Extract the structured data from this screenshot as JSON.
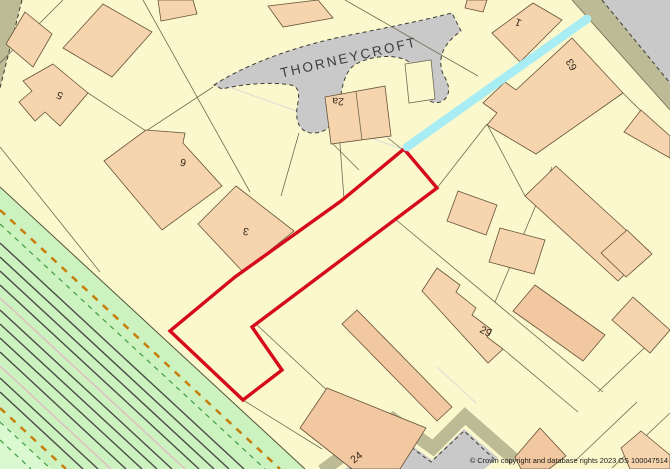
{
  "map": {
    "street_label": "THORNEYCROFT",
    "house_labels": [
      {
        "text": "5"
      },
      {
        "text": "6"
      },
      {
        "text": "3"
      },
      {
        "text": "2a"
      },
      {
        "text": "1"
      },
      {
        "text": "63"
      },
      {
        "text": "29"
      },
      {
        "text": "24"
      }
    ],
    "copyright": "© Crown copyright and database rights 2023 OS 100047514"
  },
  "colors": {
    "bg": "#fbf8cd",
    "building": "#f6d5ae",
    "building2": "#f2c8a0",
    "outline": "#65523a",
    "pline": "#6f6a52",
    "faint": "#e2e0d2",
    "road": "#c9c9c9",
    "verge": "#bcbb96",
    "rail": "#ccf2c0",
    "rail_light": "#dbf9d0",
    "fence": "#55543a",
    "track": "#4c4c46",
    "pink": "#e2b8c0",
    "orange": "#c77d0a",
    "green": "#3f9e3f",
    "red": "#d50a1a",
    "cyan": "#a9edf4",
    "street_text": "#3c3c3c",
    "label_text": "#352a1c"
  }
}
